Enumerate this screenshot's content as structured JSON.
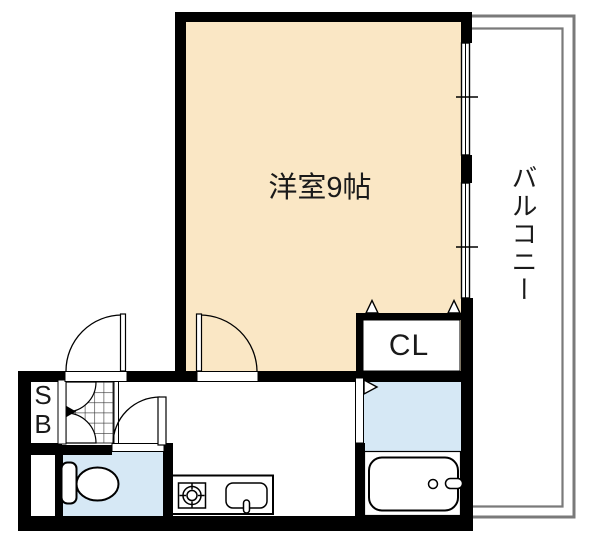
{
  "plan": {
    "type": "apartment-floor-plan",
    "rooms": {
      "western_room_label": "洋室9帖",
      "balcony_label": "バルコニー",
      "closet_label": "CL",
      "shoebox_line1": "S",
      "shoebox_line2": "B"
    },
    "fixtures": [
      "toilet",
      "bathtub",
      "kitchen-counter",
      "gas-stove",
      "kitchen-sink",
      "entrance-tile",
      "shoe-box-doors",
      "sliding-windows",
      "hinged-doors",
      "closet-folding-door-markers"
    ],
    "colors": {
      "room_fill": "#FAE7C5",
      "wet_area_fill": "#D6E8F5",
      "wall": "#000000",
      "balcony_line": "#7a7a7a",
      "hatch_line": "#333333",
      "background": "#FFFFFF"
    }
  }
}
